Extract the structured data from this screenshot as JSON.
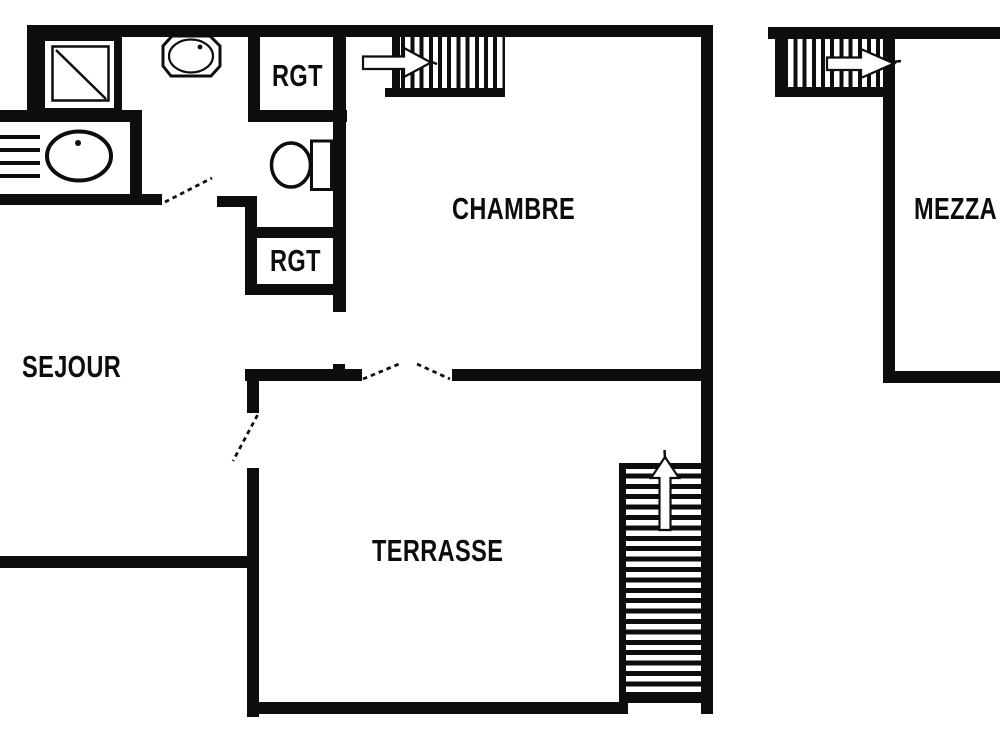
{
  "diagram": {
    "type": "apartment-floor-plan",
    "background_color": "#ffffff",
    "wall_color": "#0d0d0d",
    "label_color": "#0d0d0d"
  },
  "rooms": {
    "sejour": {
      "label": "SEJOUR"
    },
    "chambre": {
      "label": "CHAMBRE"
    },
    "terrasse": {
      "label": "TERRASSE"
    },
    "mezzanine": {
      "label": "MEZZA"
    },
    "storage_top": {
      "label": "RGT"
    },
    "storage_middle": {
      "label": "RGT"
    }
  },
  "fixtures": {
    "shower": "shower-stall-icon",
    "washbasin": "washbasin-icon",
    "kitchen_sink": "kitchen-sink-with-drainer-icon",
    "toilet": "toilet-icon",
    "stairs_chambre": "staircase-arrow-right-icon",
    "stairs_mezzanine": "staircase-arrow-right-icon",
    "stairs_terrasse": "staircase-arrow-up-icon",
    "door_swings": "dashed-door-swing-icon"
  }
}
